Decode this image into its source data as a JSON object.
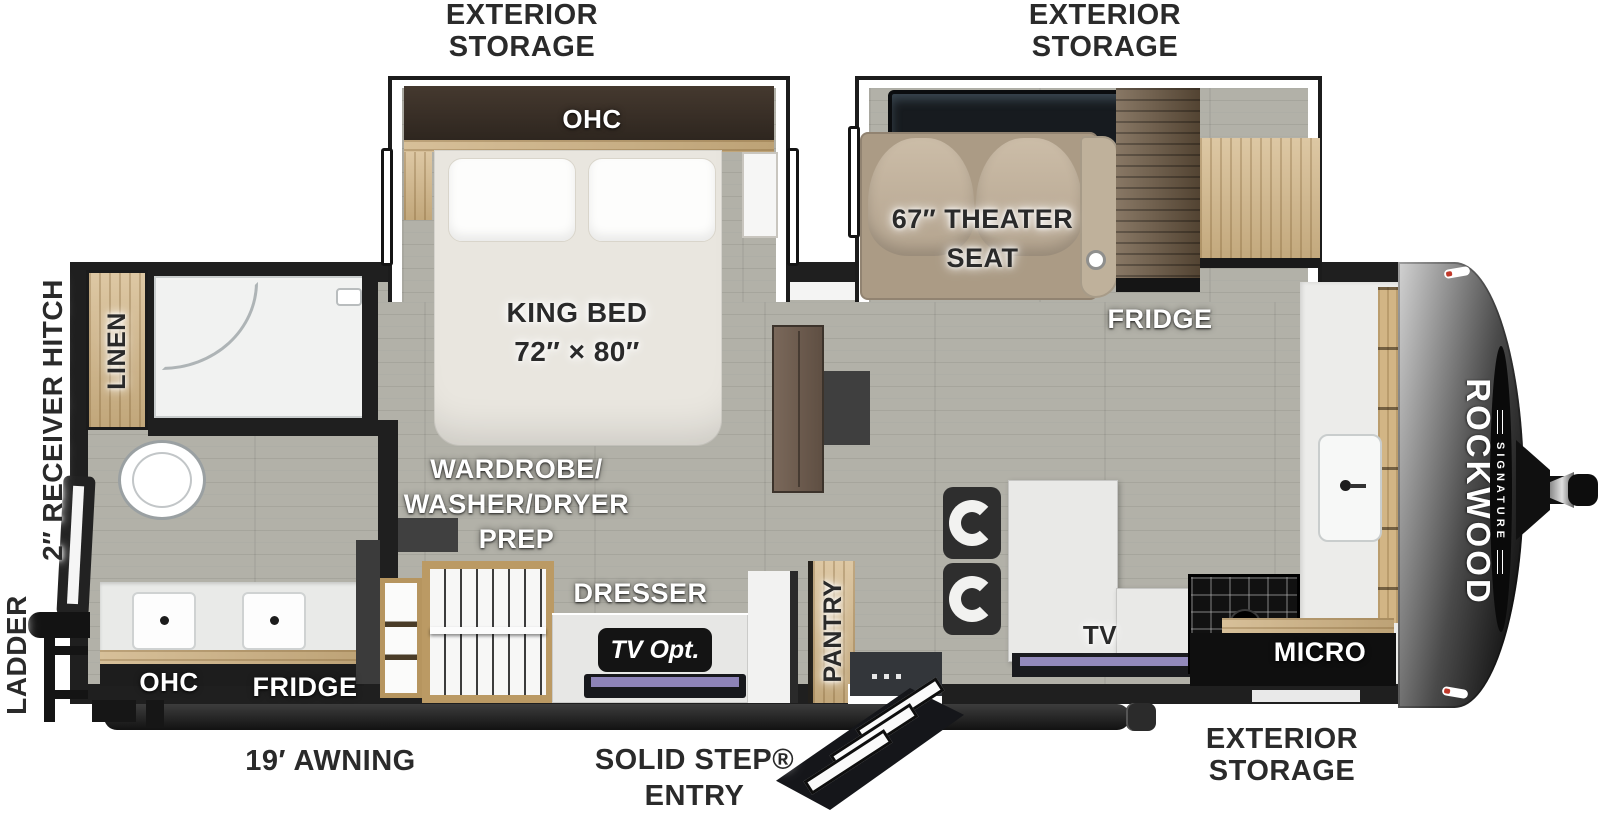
{
  "brand": {
    "name": "ROCKWOOD",
    "series": "SIGNATURE"
  },
  "exterior": {
    "storage_top_left": "EXTERIOR\nSTORAGE",
    "storage_top_right": "EXTERIOR\nSTORAGE",
    "storage_bottom_right": "EXTERIOR\nSTORAGE",
    "awning": "19′ AWNING",
    "entry": "SOLID STEP®\nENTRY",
    "ladder": "LADDER",
    "receiver_hitch": "2″ RECEIVER HITCH"
  },
  "bedroom": {
    "ohc": "OHC",
    "king_bed": "KING BED\n72″ × 80″",
    "wardrobe_prep": "WARDROBE/\nWASHER/DRYER\nPREP",
    "dresser": "DRESSER",
    "tv_option": "TV Opt."
  },
  "bathroom": {
    "linen": "LINEN",
    "ohc": "OHC",
    "fridge": "FRIDGE"
  },
  "living": {
    "theater_seat": "67″ THEATER\nSEAT",
    "fridge": "FRIDGE",
    "tv": "TV"
  },
  "kitchen": {
    "pantry": "PANTRY",
    "micro": "MICRO",
    "ohc": "OHC"
  },
  "colors": {
    "wall": "#1f1f1f",
    "floor": "#b2b1a8",
    "wood_light": "#d2b585",
    "wood_dark": "#6e5a43",
    "marker_red": "#c0392b"
  }
}
